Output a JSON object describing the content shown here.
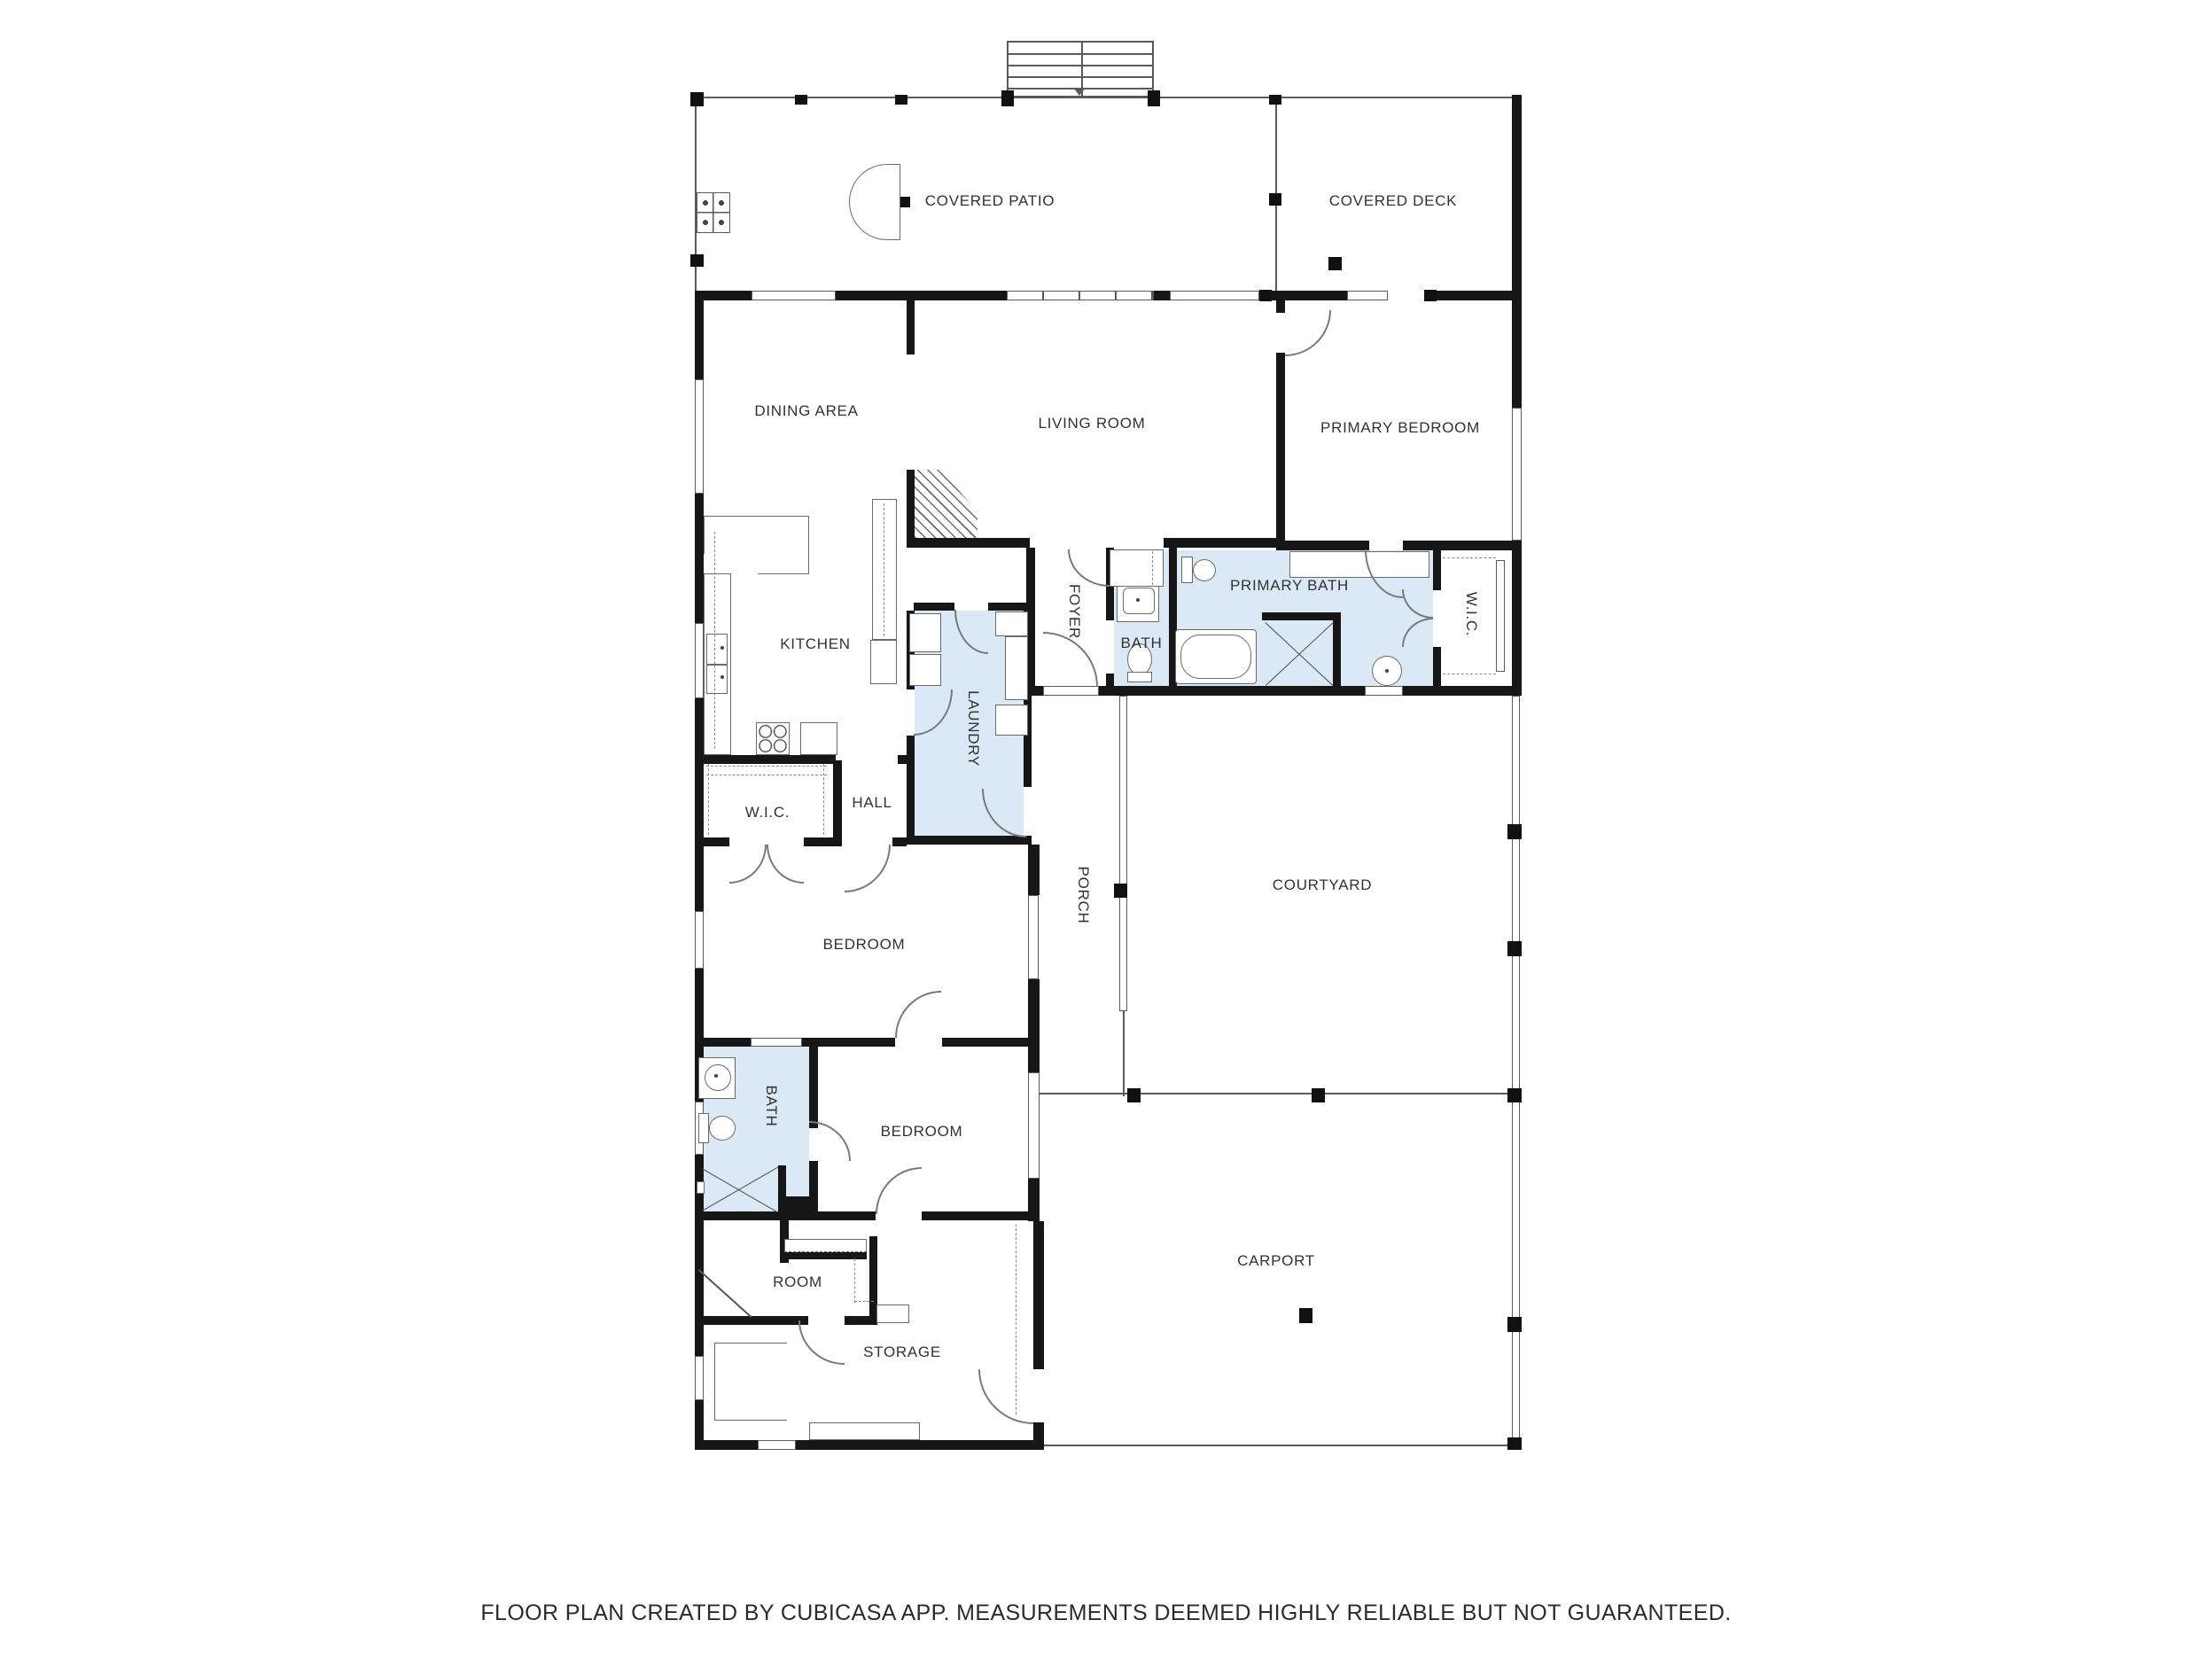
{
  "plan": {
    "footer": "FLOOR PLAN CREATED BY CUBICASA APP. MEASUREMENTS DEEMED HIGHLY RELIABLE BUT NOT GUARANTEED.",
    "colors": {
      "wall": "#161616",
      "wet_room_fill": "#dbe9f6",
      "thin_line": "#5a5a5a"
    },
    "rooms": {
      "covered_patio": {
        "label": "COVERED PATIO"
      },
      "covered_deck": {
        "label": "COVERED DECK"
      },
      "dining_area": {
        "label": "DINING AREA"
      },
      "living_room": {
        "label": "LIVING ROOM"
      },
      "primary_bedroom": {
        "label": "PRIMARY BEDROOM"
      },
      "kitchen": {
        "label": "KITCHEN"
      },
      "foyer": {
        "label": "FOYER"
      },
      "bath_upper": {
        "label": "BATH"
      },
      "primary_bath": {
        "label": "PRIMARY BATH"
      },
      "wic_right": {
        "label": "W.I.C."
      },
      "laundry": {
        "label": "LAUNDRY"
      },
      "wic_left": {
        "label": "W.I.C."
      },
      "hall": {
        "label": "HALL"
      },
      "bedroom_1": {
        "label": "BEDROOM"
      },
      "porch": {
        "label": "PORCH"
      },
      "courtyard": {
        "label": "COURTYARD"
      },
      "bath_2": {
        "label": "BATH"
      },
      "bedroom_2": {
        "label": "BEDROOM"
      },
      "room": {
        "label": "ROOM"
      },
      "storage": {
        "label": "STORAGE"
      },
      "carport": {
        "label": "CARPORT"
      }
    }
  }
}
